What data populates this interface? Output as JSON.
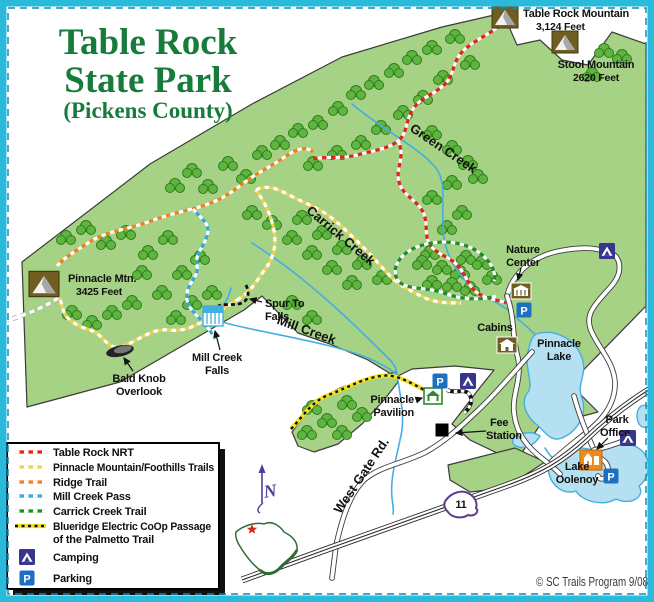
{
  "title": {
    "line1": "Table Rock",
    "line2": "State Park",
    "line3": "(Pickens County)"
  },
  "credit": "© SC Trails Program 9/08",
  "compass_label": "N",
  "highway_shield": {
    "number": "11"
  },
  "icons": {
    "parking_glyph": "P"
  },
  "map_labels": {
    "table_rock_mountain": {
      "name": "Table Rock Mountain",
      "elevation": "3,124 Feet"
    },
    "stool_mountain": {
      "name": "Stool Mountain",
      "elevation": "2620 Feet"
    },
    "pinnacle_mountain": {
      "name": "Pinnacle Mtn.",
      "elevation": "3425 Feet"
    },
    "green_creek": "Green Creek",
    "carrick_creek": "Carrick Creek",
    "mill_creek": "Mill Creek",
    "west_gate_rd": "West Gate Rd.",
    "nature_center": {
      "line1": "Nature",
      "line2": "Center"
    },
    "cabins": "Cabins",
    "pinnacle_lake": {
      "line1": "Pinnacle",
      "line2": "Lake"
    },
    "spur_to_falls": {
      "line1": "Spur To",
      "line2": "Falls"
    },
    "mill_creek_falls": {
      "line1": "Mill Creek",
      "line2": "Falls"
    },
    "bald_knob_overlook": {
      "line1": "Bald Knob",
      "line2": "Overlook"
    },
    "pinnacle_pavilion": {
      "line1": "Pinnacle",
      "line2": "Pavilion"
    },
    "fee_station": {
      "line1": "Fee",
      "line2": "Station"
    },
    "park_office": {
      "line1": "Park",
      "line2": "Office"
    },
    "lake_oolenoy": {
      "line1": "Lake",
      "line2": "Oolenoy"
    }
  },
  "legend": {
    "items": [
      {
        "label": "Table Rock NRT",
        "color": "#E2231A"
      },
      {
        "label": "Pinnacle Mountain/Foothills Trails",
        "color": "#F2CF4F"
      },
      {
        "label": "Ridge Trail",
        "color": "#F0811E"
      },
      {
        "label": "Mill Creek Pass",
        "color": "#35A8DC"
      },
      {
        "label": "Carrick Creek Trail",
        "color": "#1F8A2F"
      },
      {
        "label": "Blueridge Electric CoOp Passage",
        "label2": "of the Palmetto Trail",
        "color": "#F2E21F"
      }
    ],
    "camping_label": "Camping",
    "parking_label": "Parking"
  },
  "colors": {
    "border": "#2BB9DC",
    "park_green": "#A5D285",
    "water": "#45AEE0",
    "title_green": "#177B3B"
  }
}
